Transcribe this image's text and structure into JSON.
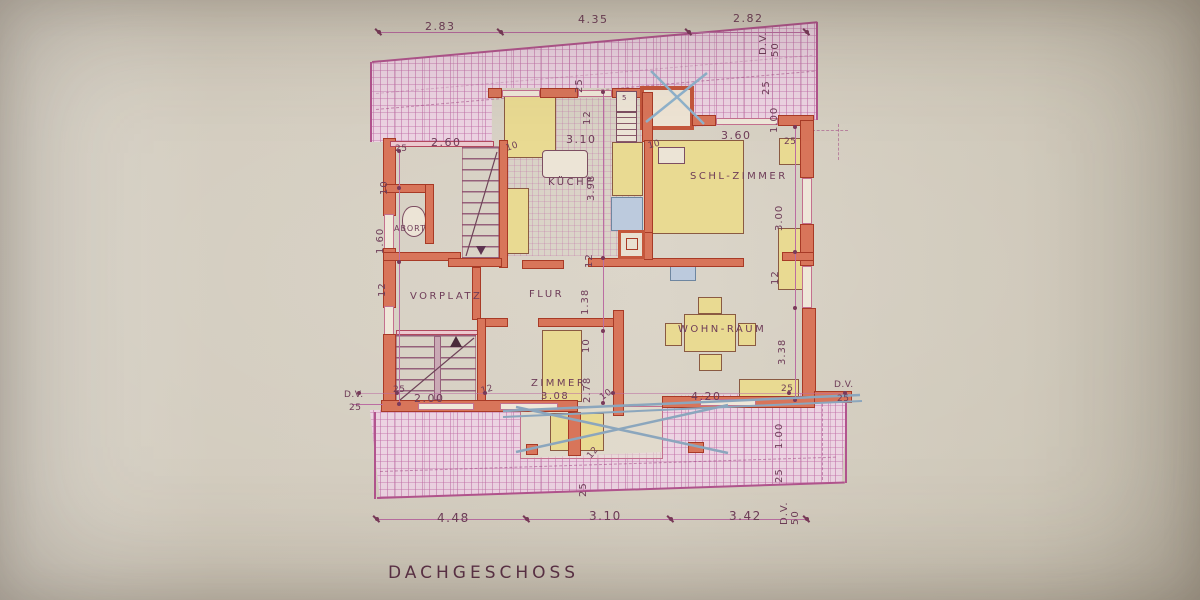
{
  "title": "DACHGESCHOSS",
  "rooms": {
    "abort": "ABORT",
    "kueche": "KÜCHE",
    "schl_zimmer": "SCHL-ZIMMER",
    "vorplatz": "VORPLATZ",
    "flur": "FLUR",
    "wohn_raum": "WOHN-RAUM",
    "zimmer": "ZIMMER",
    "zimmer_size": "3.08"
  },
  "dims": {
    "top": {
      "d1": "2.83",
      "d2": "4.35",
      "d3": "2.82",
      "dv": "D.V.",
      "dv_size": "50"
    },
    "upper_row": {
      "w25l": "25",
      "d260": "2.60",
      "t10a": "10",
      "d310": "3.10",
      "t10b": "10",
      "d360": "3.60",
      "w25r": "25"
    },
    "roof_top": {
      "v25": "25",
      "v12": "12",
      "r25": "25",
      "r100": "1.00"
    },
    "left": {
      "t10": "10",
      "d160": "1.60",
      "v12": "12"
    },
    "center": {
      "d398": "3.98",
      "v12": "12",
      "d138": "1.38",
      "t10a": "10",
      "d278": "2.78",
      "t10b": "10"
    },
    "right": {
      "d300": "3.00",
      "v12": "12",
      "d338": "3.38"
    },
    "mid_row": {
      "dv_l": "D.V.",
      "v25_l": "25",
      "w25a": "25",
      "d200": "2.00",
      "t12": "12",
      "d420": "4.20",
      "w25b": "25",
      "dv_r": "D.V.",
      "v25_r": "25"
    },
    "roof_bottom": {
      "t12": "12",
      "v25": "25",
      "r100": "1.00",
      "r25": "25",
      "dv": "D.V.",
      "dv_size": "50"
    },
    "bottom": {
      "d448": "4.48",
      "d310": "3.10",
      "d342": "3.42"
    }
  },
  "annotations": {
    "shelf_count": "5"
  },
  "colors": {
    "paper": "#d5cec0",
    "wall": "#d8755a",
    "wall_dark": "#a83a26",
    "hatch_fill": "#ecd3e2",
    "ink": "#6e3c58",
    "dim_line": "#bb6da2",
    "furniture": "#e9da92",
    "furniture_line": "#8a5a42",
    "fixture_blue": "#bccadd",
    "cross_blue": "#8fa9c4",
    "window_line": "#c4708e"
  }
}
